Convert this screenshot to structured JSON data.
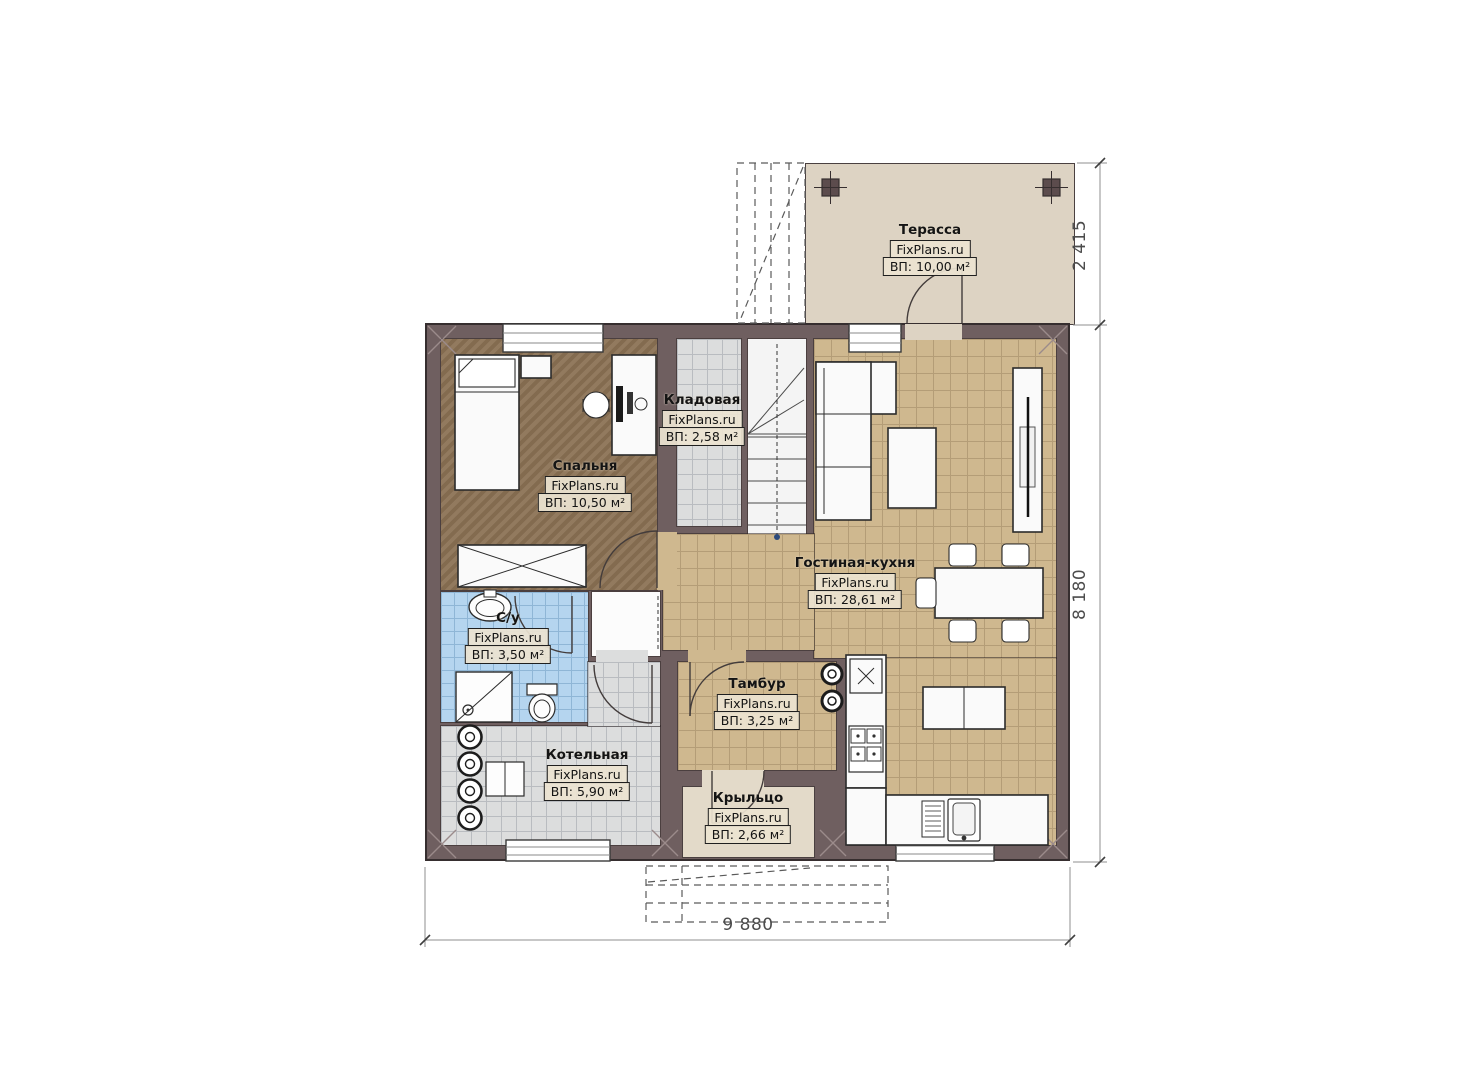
{
  "plan": {
    "watermark": "FixPlans.ru",
    "rooms": {
      "terrace": {
        "name": "Терасса",
        "area": "ВП: 10,00 м²"
      },
      "storage": {
        "name": "Кладовая",
        "area": "ВП: 2,58 м²"
      },
      "bedroom": {
        "name": "Спальня",
        "area": "ВП: 10,50 м²"
      },
      "living_kitchen": {
        "name": "Гостиная-кухня",
        "area": "ВП: 28,61 м²"
      },
      "bathroom": {
        "name": "С/у",
        "area": "ВП: 3,50 м²"
      },
      "vestibule": {
        "name": "Тамбур",
        "area": "ВП: 3,25 м²"
      },
      "boiler": {
        "name": "Котельная",
        "area": "ВП: 5,90 м²"
      },
      "porch": {
        "name": "Крыльцо",
        "area": "ВП: 2,66 м²"
      }
    },
    "dimensions": {
      "terrace_depth": "2 415",
      "house_depth": "8 180",
      "house_width": "9 880"
    },
    "colors": {
      "wall": "#6f5f60",
      "floor_wood": "#8c7356",
      "floor_tile_tan": "#cfb88f",
      "floor_tile_gray": "#dcdddd",
      "floor_tile_blue": "#b5d5ef",
      "terrace": "#ddd3c3",
      "porch": "#e3dac9",
      "label_bg": "#ece3d1",
      "furniture": "#fafafa",
      "outline": "#2b2b2b"
    }
  }
}
